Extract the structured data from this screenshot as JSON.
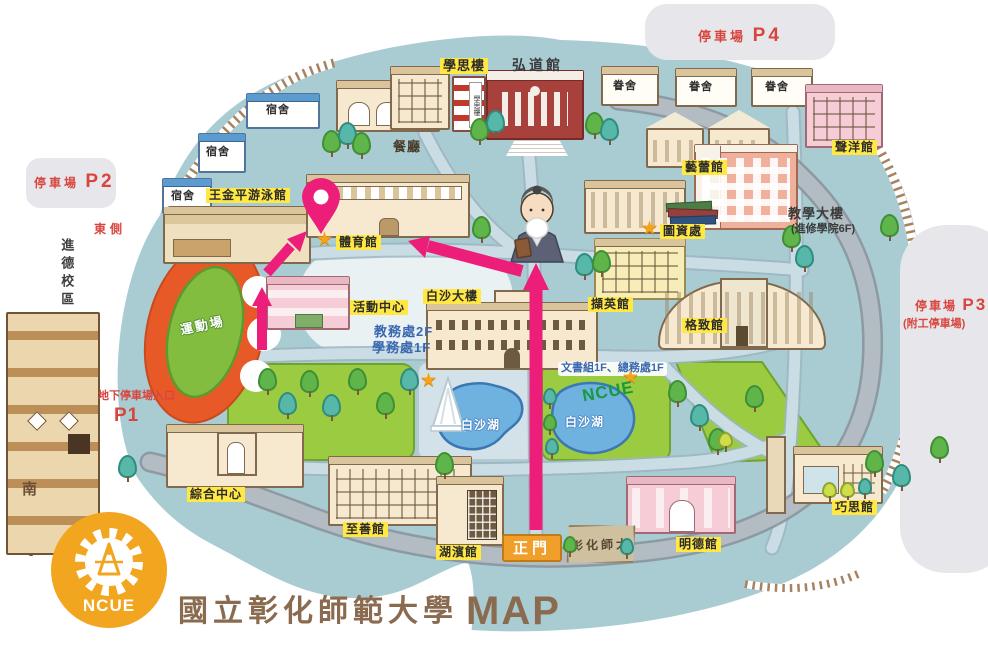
{
  "colors": {
    "route": "#ed1e79",
    "highlight": "#ffe843",
    "parking-red": "#d8453e",
    "info-blue": "#3a67b1",
    "map-teal": "#a9ccd3",
    "lawn-green": "#179a3d",
    "title-brown": "#8a6b50",
    "ncue-orange": "#f2a51f",
    "star-orange": "#f6a31c"
  },
  "icons": {
    "star": "★"
  },
  "title": {
    "university": "國立彰化師範大學",
    "map": "MAP",
    "logo": "NCUE"
  },
  "compass": {
    "south": "南"
  },
  "parking": {
    "p1": {
      "label": "地下停車場入口",
      "code": "P1"
    },
    "p2": {
      "label": "停車場",
      "code": "P2"
    },
    "p3": {
      "label": "停車場",
      "code": "P3",
      "note": "(附工停車場)"
    },
    "p4": {
      "label": "停車場",
      "code": "P4"
    }
  },
  "annotations": {
    "east_side": "東側",
    "campus_area": "進德校區",
    "lawn_text": "NCUE",
    "lake": "白沙湖",
    "offices_line1": "教務處2F",
    "offices_line2": "學務處1F",
    "offices_line3": "文書組1F、總務處1F",
    "teaching_note": "(進修學院6F)"
  },
  "buildings": {
    "dorm": "宿舍",
    "staff_dorm": "眷舍",
    "pool": "王金平游泳館",
    "cafeteria": "餐廳",
    "xuesi": "學思樓",
    "hongdao": "弘道館",
    "shengyang": "聲洋館",
    "yilei": "藝蕾館",
    "teaching": "教學大樓",
    "library": "圖資處",
    "gym": "體育館",
    "activity": "活動中心",
    "baisha": "白沙大樓",
    "gezhi": "格致館",
    "xieying": "擷英館",
    "complex": "綜合中心",
    "zhishan": "至善館",
    "hubin": "湖濱館",
    "mingde": "明德館",
    "qiaosi": "巧思館",
    "track": "運動場",
    "main_gate": "正門",
    "gate_stone": "彰化師大"
  }
}
